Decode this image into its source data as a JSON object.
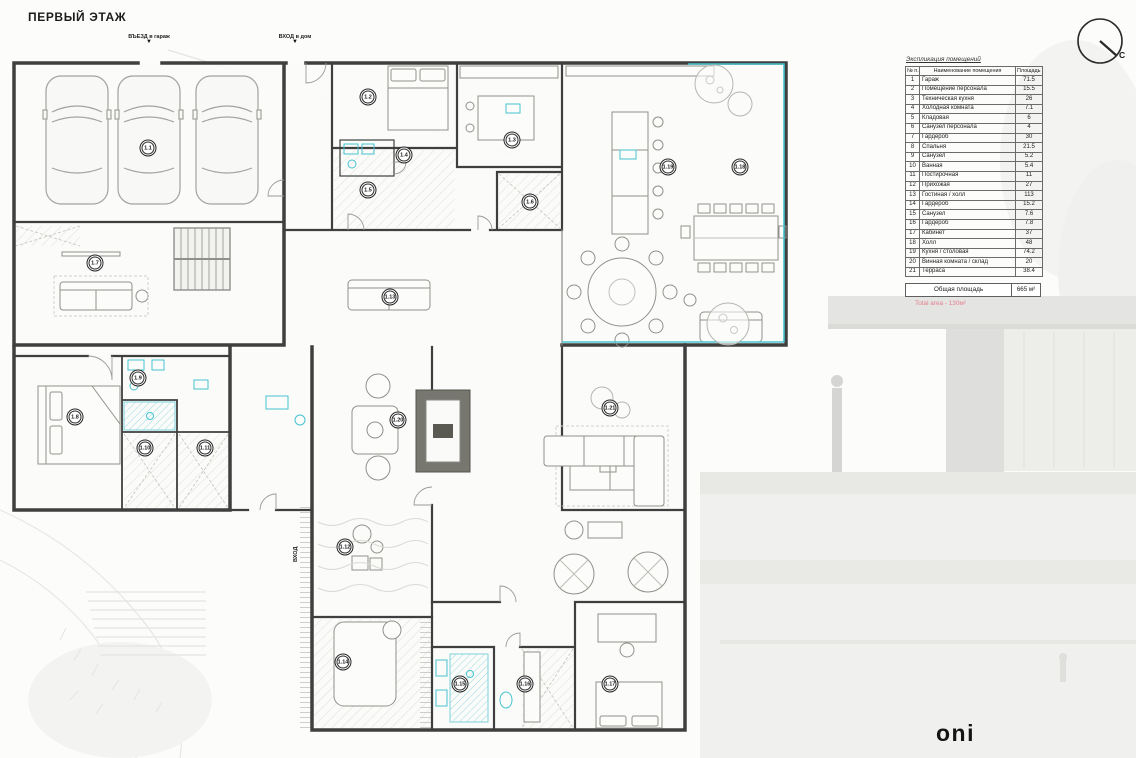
{
  "title": "ПЕРВЫЙ ЭТАЖ",
  "entrances": {
    "garage_label": "ВЪЕЗД в гараж",
    "house_label": "ВХОД в дом",
    "street_label": "ВХОД",
    "arrow": "▼"
  },
  "compass": {
    "north_label": "С"
  },
  "logo_text": "oni",
  "legend": {
    "caption": "Экспликация помещений",
    "columns": {
      "num": "№ п.п",
      "name": "Наименование помещения",
      "area": "Площадь м²"
    },
    "rows": [
      {
        "num": "1",
        "name": "Гараж",
        "area": "71.5"
      },
      {
        "num": "2",
        "name": "Помещение персонала",
        "area": "15.5"
      },
      {
        "num": "3",
        "name": "Техническая кухня",
        "area": "26"
      },
      {
        "num": "4",
        "name": "Холодная комната",
        "area": "7.1"
      },
      {
        "num": "5",
        "name": "Кладовая",
        "area": "6"
      },
      {
        "num": "6",
        "name": "Санузел персонала",
        "area": "4"
      },
      {
        "num": "7",
        "name": "Гардероб",
        "area": "30"
      },
      {
        "num": "8",
        "name": "Спальня",
        "area": "21.5"
      },
      {
        "num": "9",
        "name": "Санузел",
        "area": "5.2"
      },
      {
        "num": "10",
        "name": "Ванная",
        "area": "5.4"
      },
      {
        "num": "11",
        "name": "Постирочная",
        "area": "11"
      },
      {
        "num": "12",
        "name": "Прихожая",
        "area": "27"
      },
      {
        "num": "13",
        "name": "Гостиная / холл",
        "area": "113"
      },
      {
        "num": "14",
        "name": "Гардероб",
        "area": "15.2"
      },
      {
        "num": "15",
        "name": "Санузел",
        "area": "7.6"
      },
      {
        "num": "16",
        "name": "Гардероб",
        "area": "7.8"
      },
      {
        "num": "17",
        "name": "Кабинет",
        "area": "37"
      },
      {
        "num": "18",
        "name": "Холл",
        "area": "48"
      },
      {
        "num": "19",
        "name": "Кухня / столовая",
        "area": "74.2"
      },
      {
        "num": "20",
        "name": "Винная комната / склад",
        "area": "20"
      },
      {
        "num": "21",
        "name": "Терраса",
        "area": "38.4"
      }
    ],
    "total_label": "Общая площадь",
    "total_value": "665 м²",
    "total_note": "Total area - 130м²"
  },
  "plan": {
    "room_labels": [
      {
        "id": "1.1",
        "x": 148,
        "y": 148
      },
      {
        "id": "1.2",
        "x": 368,
        "y": 97
      },
      {
        "id": "1.3",
        "x": 512,
        "y": 140
      },
      {
        "id": "1.4",
        "x": 404,
        "y": 155
      },
      {
        "id": "1.5",
        "x": 368,
        "y": 190
      },
      {
        "id": "1.6",
        "x": 530,
        "y": 202
      },
      {
        "id": "1.19",
        "x": 668,
        "y": 167
      },
      {
        "id": "1.18",
        "x": 740,
        "y": 167
      },
      {
        "id": "1.7",
        "x": 95,
        "y": 263
      },
      {
        "id": "1.13",
        "x": 390,
        "y": 297
      },
      {
        "id": "1.9",
        "x": 138,
        "y": 378
      },
      {
        "id": "1.8",
        "x": 75,
        "y": 417
      },
      {
        "id": "1.10",
        "x": 145,
        "y": 448
      },
      {
        "id": "1.11",
        "x": 205,
        "y": 448
      },
      {
        "id": "1.20",
        "x": 398,
        "y": 420
      },
      {
        "id": "1.21",
        "x": 610,
        "y": 408
      },
      {
        "id": "1.12",
        "x": 345,
        "y": 547
      },
      {
        "id": "1.14",
        "x": 343,
        "y": 662
      },
      {
        "id": "1.15",
        "x": 460,
        "y": 684
      },
      {
        "id": "1.16",
        "x": 525,
        "y": 684
      },
      {
        "id": "1.17",
        "x": 610,
        "y": 684
      }
    ]
  },
  "colors": {
    "accent_teal": "#45c3cf",
    "accent_teal_light": "#9adde4",
    "wall": "#3f3f3f",
    "note_red": "#e4808e"
  }
}
